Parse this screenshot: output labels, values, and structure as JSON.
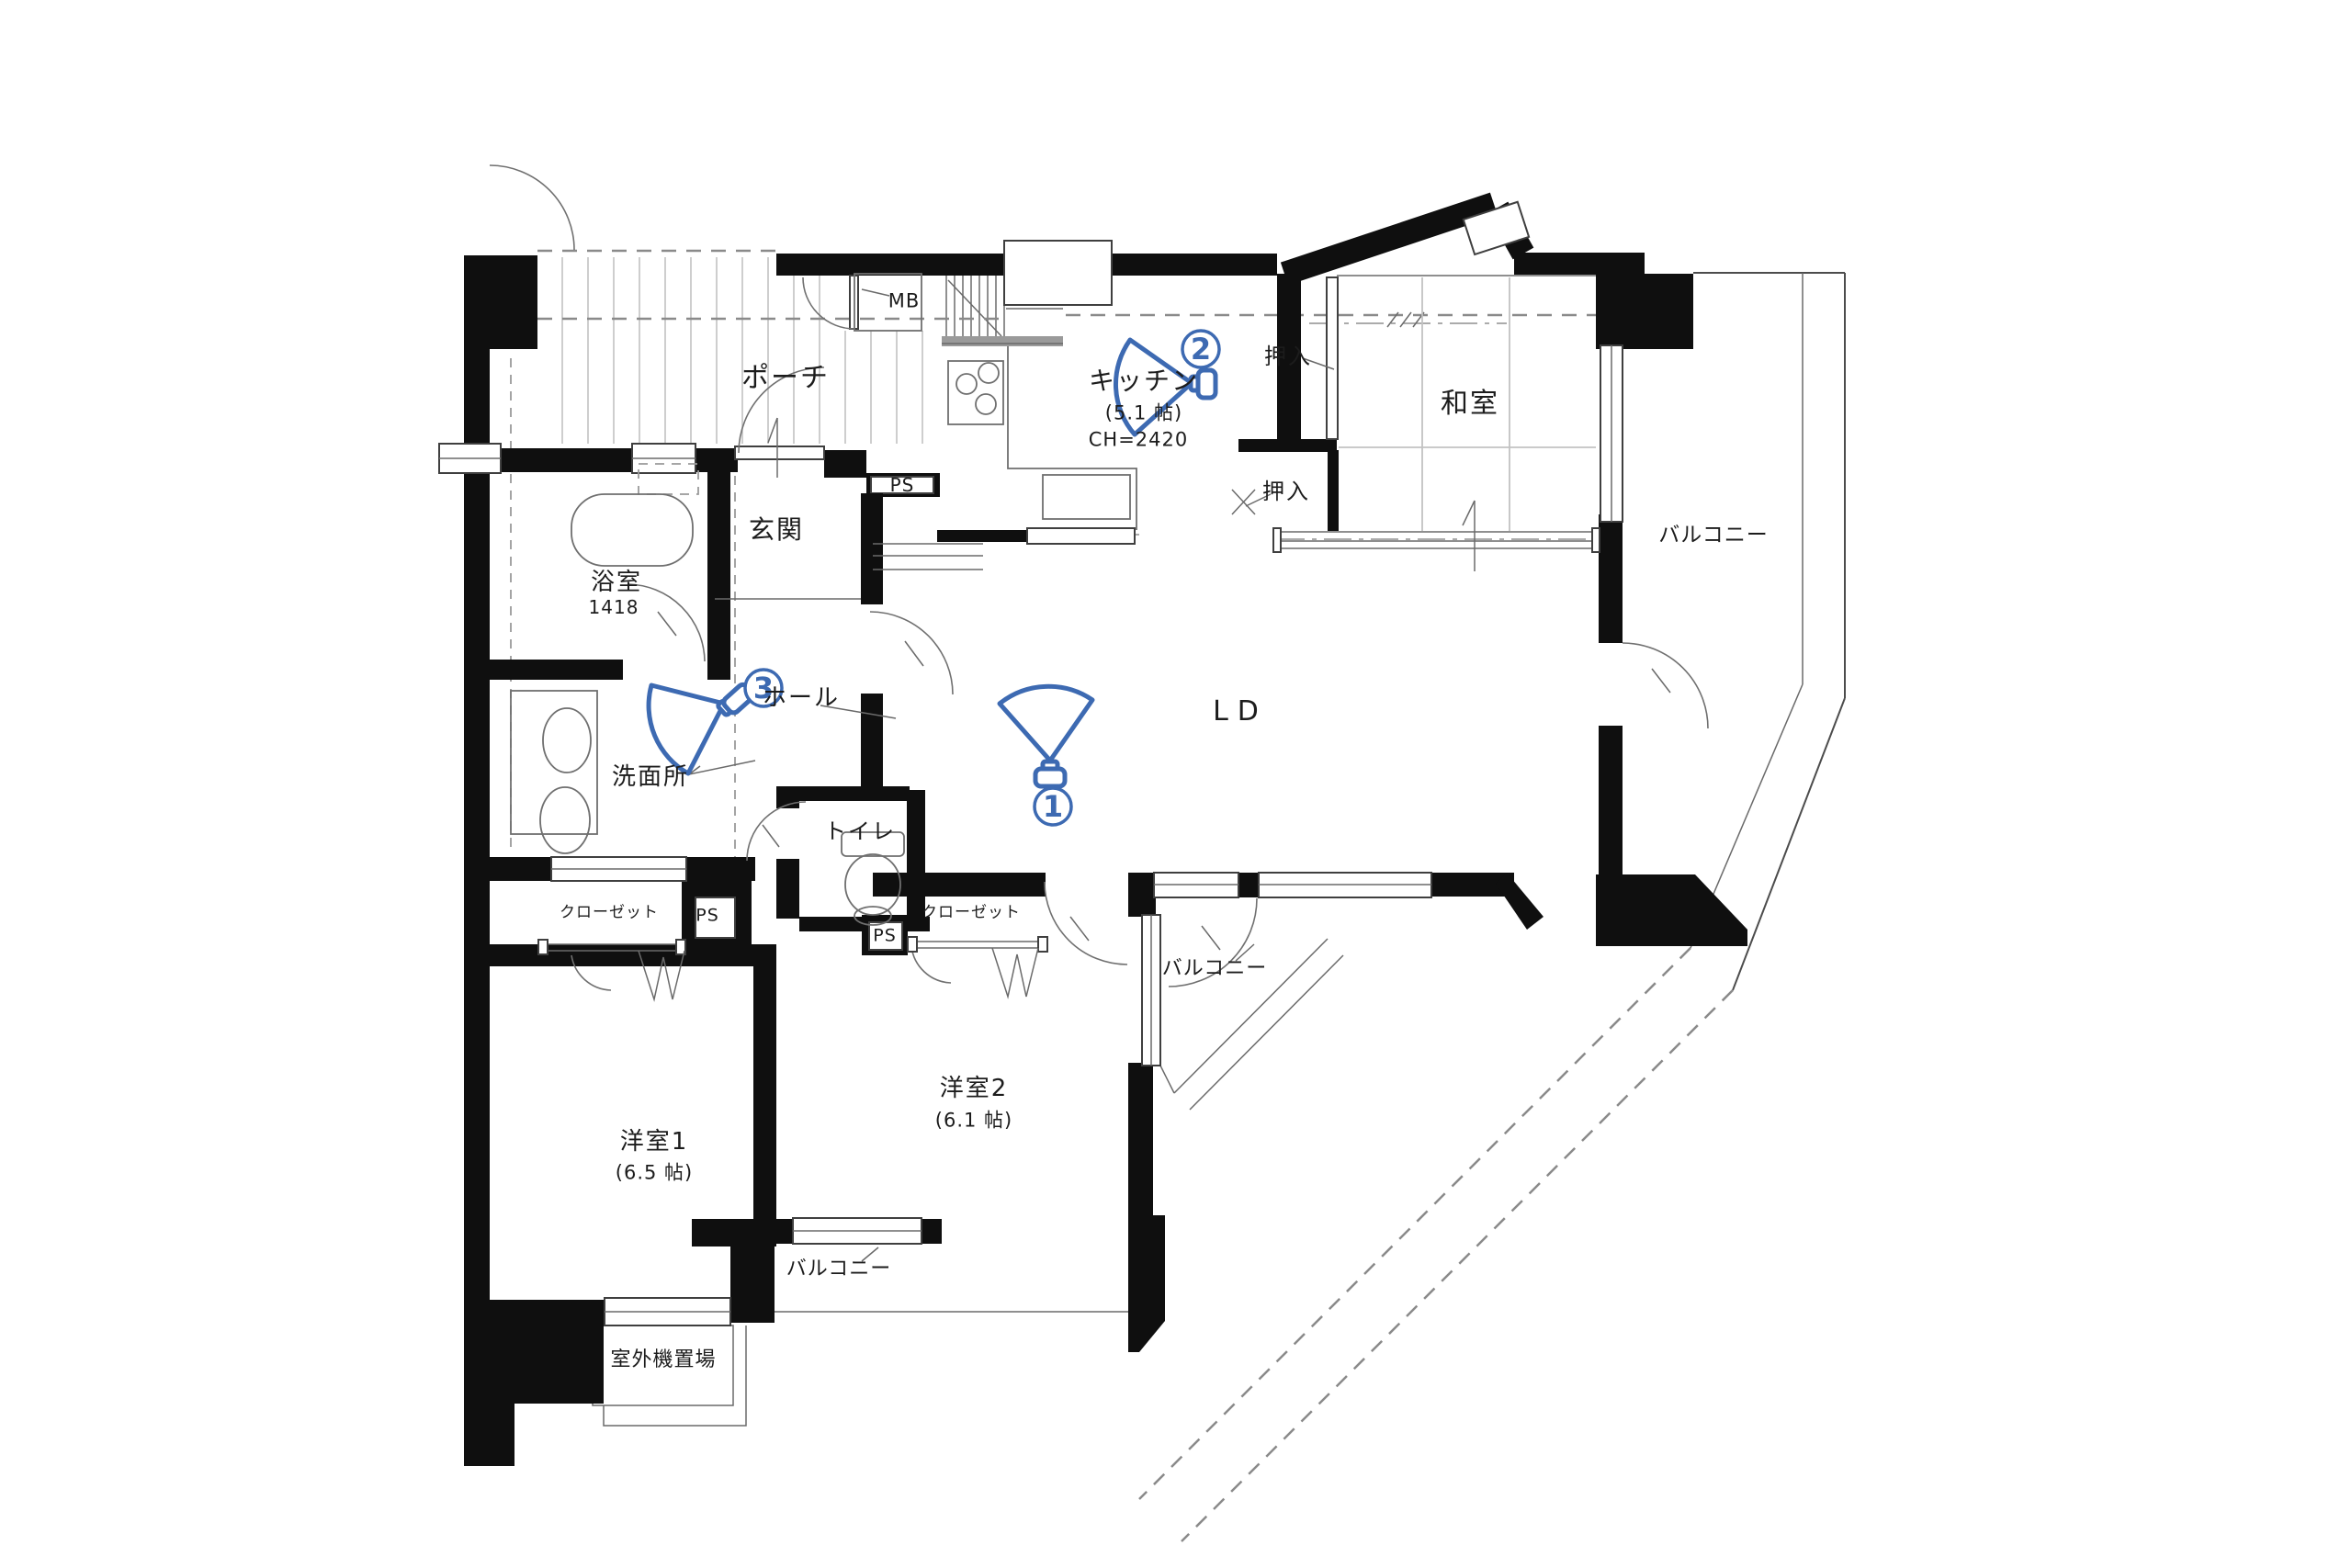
{
  "plan": {
    "rooms": {
      "porch": "ポーチ",
      "mb": "MB",
      "kitchen": "キッチン",
      "kitchen_size": "(5.1 帖)",
      "kitchen_ch": "CH=2420",
      "closet_upper": "押入",
      "closet_lower": "押入",
      "washitsu": "和室",
      "balcony_right": "バルコニー",
      "balcony_ld": "バルコニー",
      "balcony_south": "バルコニー",
      "genkan": "玄関",
      "ps_top": "PS",
      "ps_left": "PS",
      "ps_right": "PS",
      "bath": "浴室",
      "bath_size": "1418",
      "hall": "ホール",
      "washroom": "洗面所",
      "toilet": "トイレ",
      "closet_left": "クローゼット",
      "closet_right": "クローゼット",
      "bedroom1": "洋室1",
      "bedroom1_size": "(6.5 帖)",
      "bedroom2": "洋室2",
      "bedroom2_size": "(6.1 帖)",
      "outdoor_unit": "室外機置場",
      "living": "LD"
    },
    "cameras": [
      {
        "number": "1"
      },
      {
        "number": "2"
      },
      {
        "number": "3"
      }
    ],
    "colors": {
      "camera_accent": "#3d6ab2",
      "wall": "#0f0f0f",
      "background": "#ffffff"
    }
  }
}
